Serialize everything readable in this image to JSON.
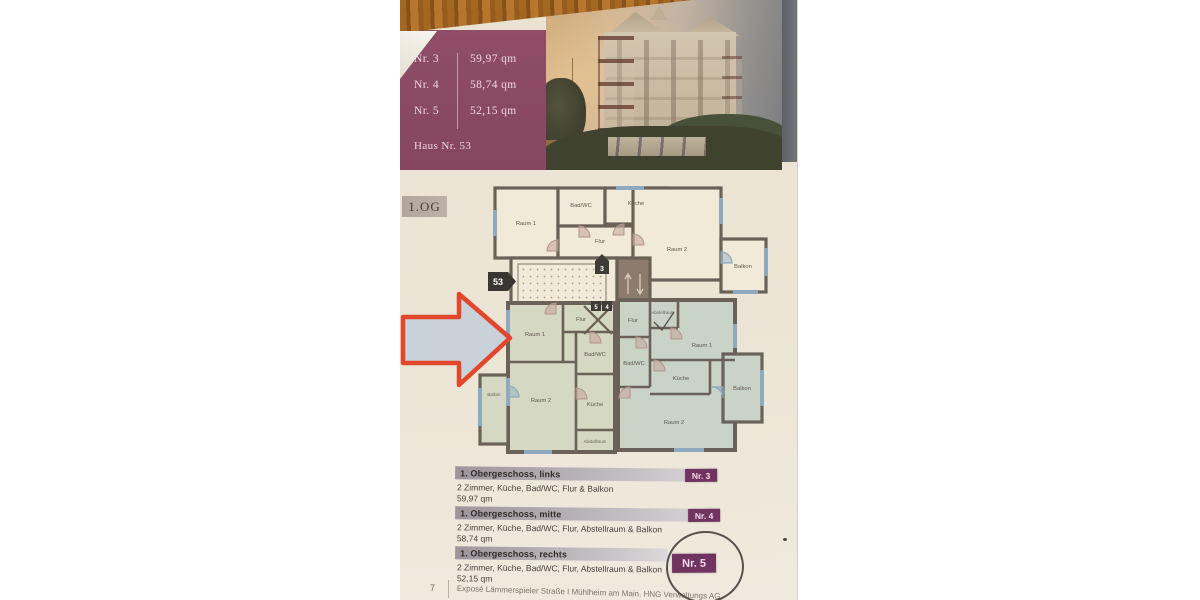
{
  "header": {
    "units": [
      {
        "nr": "Nr. 3",
        "area": "59,97 qm"
      },
      {
        "nr": "Nr. 4",
        "area": "58,74 qm"
      },
      {
        "nr": "Nr. 5",
        "area": "52,15 qm"
      }
    ],
    "house_label": "Haus Nr. 53"
  },
  "floor_label": "1.OG",
  "plan": {
    "house_badge": "53",
    "entrance_badge": "3",
    "door_badges": [
      "5",
      "4"
    ],
    "top_apartment": {
      "raum1": "Raum 1",
      "badwc": "Bad/WC",
      "kueche": "Küche",
      "flur": "Flur",
      "raum2": "Raum 2",
      "balkon": "Balkon"
    },
    "left_apartment": {
      "raum1": "Raum 1",
      "flur": "Flur",
      "badwc": "Bad/WC",
      "raum2": "Raum 2",
      "kueche": "Küche",
      "abstellraum": "Abstellraum",
      "balkon": "Balkon"
    },
    "right_apartment": {
      "flur": "Flur",
      "abstellraum": "Abstellraum",
      "raum1": "Raum 1",
      "badwc": "Bad/WC",
      "kueche": "Küche",
      "raum2": "Raum 2",
      "balkon": "Balkon"
    }
  },
  "listings": [
    {
      "title": "1. Obergeschoss, links",
      "rooms": "2 Zimmer, Küche, Bad/WC, Flur & Balkon",
      "area": "59,97 qm",
      "badge": "Nr. 3"
    },
    {
      "title": "1. Obergeschoss, mitte",
      "rooms": "2 Zimmer, Küche, Bad/WC, Flur, Abstellraum & Balkon",
      "area": "58,74 qm",
      "badge": "Nr. 4"
    },
    {
      "title": "1. Obergeschoss, rechts",
      "rooms": "2 Zimmer, Küche, Bad/WC, Flur, Abstellraum & Balkon",
      "area": "52,15 qm",
      "badge": "Nr. 5"
    }
  ],
  "footer": {
    "page_number": "7",
    "text": "Exposé Lämmerspieler Straße I Mühlheim am Main. HNG Verwaltungs AG"
  },
  "colors": {
    "accent_purple": "#8f4d67",
    "badge_purple": "#713461",
    "arrow_red": "#e2462b",
    "plan_wall": "#6a6158",
    "window_blue": "#8fa9be"
  }
}
